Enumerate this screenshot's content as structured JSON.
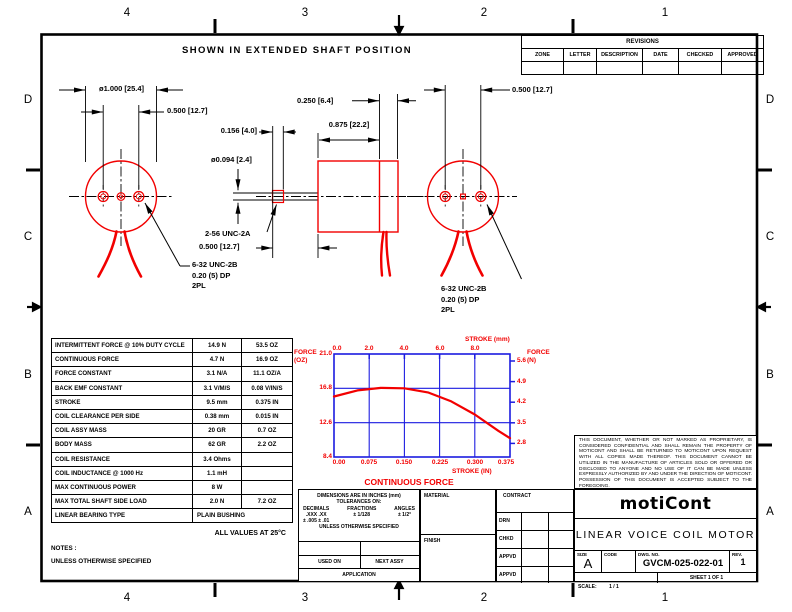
{
  "sheet_title": "SHOWN IN EXTENDED SHAFT POSITION",
  "zones": {
    "cols": [
      "4",
      "3",
      "2",
      "1"
    ],
    "rows": [
      "D",
      "C",
      "B",
      "A"
    ]
  },
  "revisions": {
    "title": "REVISIONS",
    "columns": [
      "ZONE",
      "LETTER",
      "DESCRIPTION",
      "DATE",
      "CHECKED",
      "APPROVED"
    ]
  },
  "dims": {
    "dia_mount_circle": "ø1.000 [25.4]",
    "hole_spacing": "0.500 [12.7]",
    "thread_len": "0.156 [4.0]",
    "shaft_dia": "ø0.094 [2.4]",
    "shaft_thread": "2-56 UNC-2A",
    "shaft_ext": "0.500 [12.7]",
    "body_len": "0.875 [22.2]",
    "cap_len": "0.250 [6.4]",
    "hole_spacing_right": "0.500 [12.7]",
    "tap_note_l1": "6-32 UNC-2B",
    "tap_note_l2": "0.20 (5) DP",
    "tap_note_l3": "2PL"
  },
  "spec_table": {
    "rows": [
      {
        "label": "INTERMITTENT FORCE @ 10% DUTY CYCLE",
        "metric": "14.9 N",
        "imperial": "53.5 OZ"
      },
      {
        "label": "CONTINUOUS FORCE",
        "metric": "4.7 N",
        "imperial": "16.9 OZ"
      },
      {
        "label": "FORCE CONSTANT",
        "metric": "3.1 N/A",
        "imperial": "11.1 OZ/A"
      },
      {
        "label": "BACK EMF CONSTANT",
        "metric": "3.1 V/M/S",
        "imperial": "0.08 V/IN/S"
      },
      {
        "label": "STROKE",
        "metric": "9.5 mm",
        "imperial": "0.375 IN"
      },
      {
        "label": "COIL CLEARANCE PER SIDE",
        "metric": "0.38 mm",
        "imperial": "0.015 IN"
      },
      {
        "label": "COIL ASSY MASS",
        "metric": "20 GR",
        "imperial": "0.7 OZ"
      },
      {
        "label": "BODY MASS",
        "metric": "62 GR",
        "imperial": "2.2 OZ"
      },
      {
        "label": "COIL RESISTANCE",
        "metric": "3.4 Ohms",
        "imperial": ""
      },
      {
        "label": "COIL INDUCTANCE @ 1000 Hz",
        "metric": "1.1 mH",
        "imperial": ""
      },
      {
        "label": "MAX CONTINUOUS POWER",
        "metric": "8 W",
        "imperial": ""
      },
      {
        "label": "MAX TOTAL SHAFT SIDE LOAD",
        "metric": "2.0 N",
        "imperial": "7.2 OZ"
      },
      {
        "label": "LINEAR BEARING TYPE",
        "metric": "PLAIN BUSHING",
        "imperial": ""
      }
    ],
    "footnote": "ALL VALUES AT 25°C"
  },
  "notes": {
    "line1": "NOTES :",
    "line2": "UNLESS OTHERWISE SPECIFIED"
  },
  "chart_data": {
    "type": "line",
    "title": "CONTINUOUS FORCE",
    "series": [
      {
        "name": "CONTINUOUS FORCE",
        "x_in": [
          0,
          0.05,
          0.1,
          0.15,
          0.2,
          0.25,
          0.3,
          0.35,
          0.375
        ],
        "force_oz": [
          15.8,
          16.55,
          16.85,
          16.8,
          16.3,
          15.2,
          13.6,
          11.6,
          10.7
        ]
      }
    ],
    "axes": {
      "left": {
        "label1": "FORCE",
        "label2": "(OZ)",
        "ticks": [
          "21.0",
          "16.8",
          "12.6",
          "8.4"
        ],
        "range": [
          8.4,
          21.0
        ]
      },
      "right": {
        "label1": "FORCE",
        "label2": "(N)",
        "ticks": [
          "5.6",
          "4.9",
          "4.2",
          "3.5",
          "2.8"
        ]
      },
      "top": {
        "label": "STROKE (mm)",
        "ticks": [
          "0.0",
          "2.0",
          "4.0",
          "6.0",
          "8.0"
        ]
      },
      "bottom": {
        "label": "STROKE (IN)",
        "ticks": [
          "0.00",
          "0.075",
          "0.150",
          "0.225",
          "0.300",
          "0.375"
        ],
        "range": [
          0,
          0.375
        ]
      }
    },
    "grid": true,
    "legend": "none",
    "frame_color": "#1c1ce0",
    "curve_color": "#f20000"
  },
  "tolerance_block": {
    "line1": "DIMENSIONS ARE IN INCHES (mm)",
    "line2": "TOLERANCES ON:",
    "decimals_hdr": "DECIMALS",
    "decimals_1": ".XXX  .XX",
    "decimals_2": "± .005 ± .01",
    "fractions_hdr": "FRACTIONS",
    "fractions_val": "± 1/128",
    "angles_hdr": "ANGLES",
    "angles_val": "± 1/2°",
    "line3": "UNLESS OTHERWISE SPECIFIED",
    "used_on": "USED ON",
    "next_assy": "NEXT ASSY",
    "application": "APPLICATION"
  },
  "material_block": {
    "material": "MATERIAL",
    "finish": "FINISH"
  },
  "contract_block": {
    "contract": "CONTRACT",
    "rows": [
      "DRN",
      "CHKD",
      "APPVD",
      "APPVD"
    ]
  },
  "title_block": {
    "proprietary": "THIS DOCUMENT, WHETHER OR NOT MARKED AS PROPRIETARY, IS CONSIDERED CONFIDENTIAL AND SHALL REMAIN THE PROPERTY OF MOTICONT AND SHALL BE RETURNED TO MOTICONT UPON REQUEST WITH ALL COPIES MADE THEREOF. THIS DOCUMENT CANNOT BE UTILIZED IN THE MANUFACTURE OF ARTICLES SOLD OR OFFERED OR DISCLOSED TO ANYONE AND NO USE OF IT CAN BE MADE UNLESS EXPRESSLY AUTHORIZED BY AND UNDER THE DIRECTION OF MOTICONT. POSSESSION OF THIS DOCUMENT IS ACCEPTED SUBJECT TO THE FOREGOING.",
    "logo": "motiCont",
    "title": "LINEAR VOICE COIL MOTOR",
    "size_label": "SIZE",
    "size": "A",
    "code_label": "CODE",
    "dwg_label": "DWG. NO.",
    "dwg_no": "GVCM-025-022-01",
    "rev_label": "REV.",
    "rev": "1",
    "scale_label": "SCALE:",
    "scale_value": "1 / 1",
    "sheet_text": "SHEET 1 OF 1"
  },
  "colors": {
    "drawing_red": "#f20000",
    "chart_blue": "#1c1ce0",
    "line_black": "#000000"
  }
}
